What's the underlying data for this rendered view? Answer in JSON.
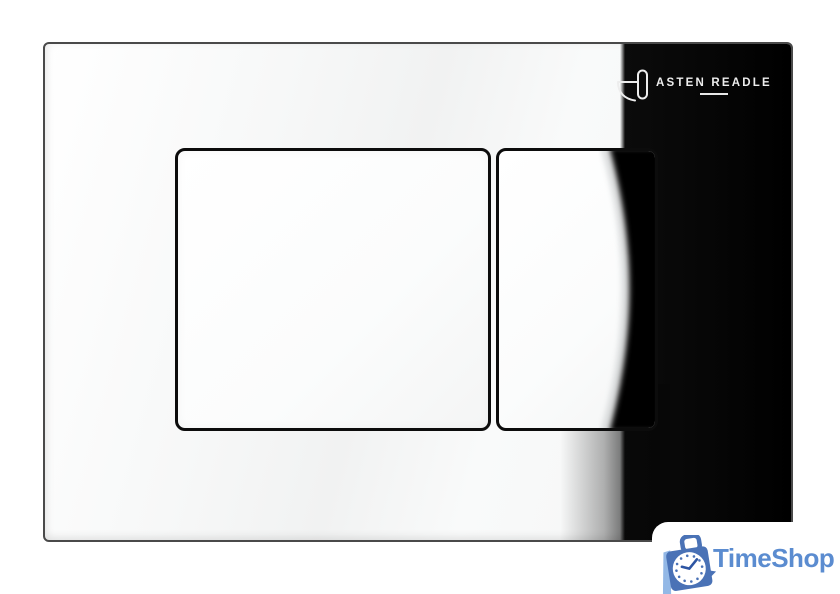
{
  "brand": {
    "name": "ASTEN READLE",
    "icon": "faucet-icon",
    "text_color": "#ededed"
  },
  "watermark": {
    "name": "TimeShop",
    "icon": "shopping-bag-clock-icon",
    "text_color": "#5b8cd0",
    "bag_color": "#4a72b6",
    "stripe_color": "#93b8e6",
    "clock_hand_color": "#2d55a3"
  },
  "colors": {
    "panel_black": "#070707",
    "chrome_white": "#f7f8f8",
    "button_border": "#0c0c0c"
  }
}
